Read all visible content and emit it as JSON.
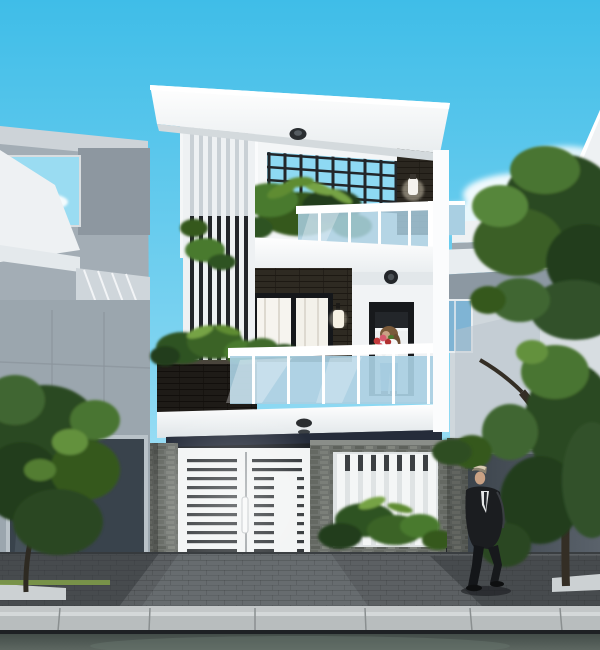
{
  "scene": {
    "type": "architectural-exterior-render",
    "subject": "Modern three-storey narrow townhouse, street elevation, daytime",
    "sky": "clear blue sky, soft white clouds on the right and inside left neighbor reflection window",
    "main_house": {
      "roof": "white flat cantilevered roof slab with recessed round downlight",
      "top_terrace": "black pergola lattice open to sky, dark slat column with white wall sconce, white vertical louver screen on left, tropical plants, glass railing with white handrail",
      "second_floor": "dark brick feature wall with black-framed window, white wall lamp, black-framed doorway, flush round ceiling light, blue glass balcony railing with white posts, dark stone planter box below louver screen",
      "ground_floor": "white slab with downlight, dark shadow recess, white horizontal-slat double gate with vertical handle, gray split-stone fence with white vertical-slat opening and shrubs"
    },
    "left_building": "gray modern neighbor house with sky-reflecting window, diagonal louver awning, dark glass garage front, tree in front",
    "right_building": "white neighbor house with sloped parapet, stacked slab overhangs, blue glass window, dark gray fence, large street tree",
    "people": [
      {
        "id": "woman-on-balcony",
        "description": "woman with brown hair, white top and blue jeans holding a red flower bouquet, standing in the second-floor doorway"
      },
      {
        "id": "man-on-sidewalk",
        "description": "man in a dark suit with white shirt walking right on the sidewalk"
      }
    ],
    "street": "dark paver sidewalk, light concrete curb, greenish asphalt road at bottom",
    "vegetation": "dark green street trees left and right, balcony and fence shrubs, grass strips at wall bases"
  },
  "palette": {
    "sky-top": "#3fbde8",
    "sky-mid": "#7fd4f1",
    "sky-low": "#cdeffa",
    "cloud": "#ffffff",
    "wall-white": "#f7f9fa",
    "wall-bright": "#ffffff",
    "wall-shade": "#dde3e7",
    "ceiling-shade": "#d4dadd",
    "dark-brick": "#38322a",
    "dark-slat": "#23262a",
    "glass-blue": "#a9cfe2",
    "glass-deep": "#7fb4d4",
    "stone": "#6f736e",
    "stone-dark": "#595d58",
    "gate-white": "#f2f4f4",
    "slot-dark": "#2d3134",
    "neighbor-gray": "#a3adb5",
    "neighbor-dark": "#39434c",
    "fence-gray": "#4f5760",
    "foliage-dark": "#243d1a",
    "foliage-mid": "#35591f",
    "foliage-light": "#5f8c33",
    "foliage-bright": "#76a344",
    "pavement": "#5c6063",
    "pavement-light": "#71767a",
    "curb-light": "#b8bdbe",
    "road": "#4e5854",
    "suit-dark": "#1b1d20",
    "skin": "#c9a184",
    "jeans-blue": "#7ba2c6",
    "flower-red": "#c23b3b"
  }
}
